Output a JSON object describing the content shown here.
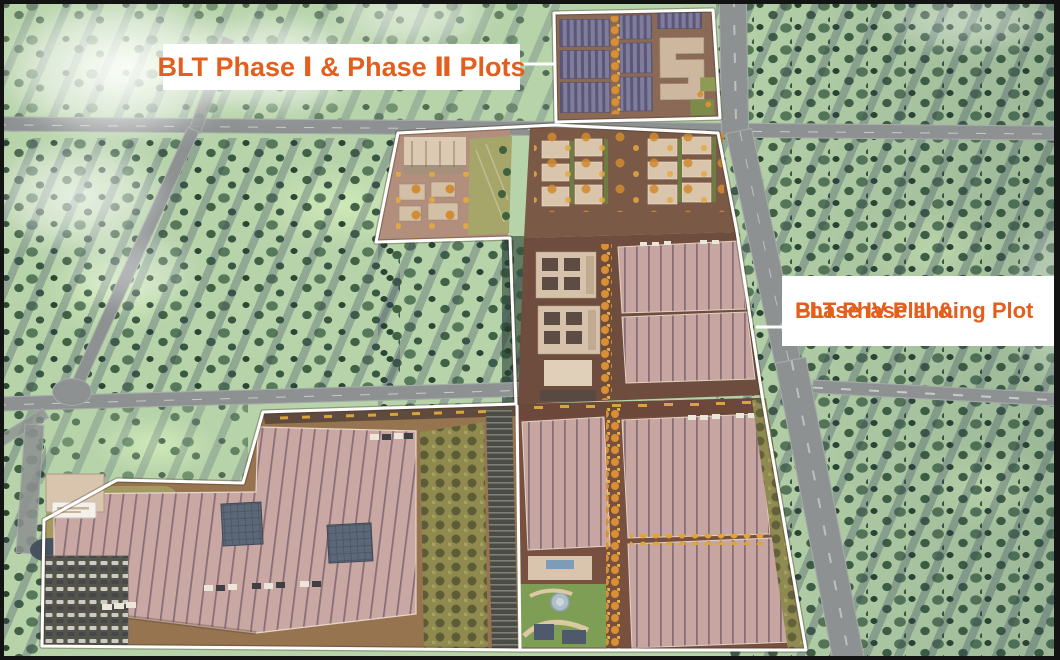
{
  "annotations": {
    "phase_1_2": {
      "label": "BLT Phase Ⅰ & Phase Ⅱ Plots"
    },
    "phase_3_4": {
      "label_line1": "BLT Phase III &",
      "label_line2": "Phase IV Planning Plot"
    }
  },
  "colors": {
    "annotation_text": "#e45f1d",
    "annotation_bg": "#ffffff",
    "plot_outline": "#ffffff",
    "field_green": "#b7d3aa",
    "road_gray": "#8d9191",
    "ground_brown": "#7a5645",
    "roof_pink": "#c7a5a1",
    "roof_seam": "#8a6e77",
    "roof_purple": "#7d7a9c",
    "building_tan": "#d9c5ab",
    "autumn_orange": "#d98f33",
    "autumn_yellow": "#e0a43c",
    "olive_field": "#a6a66b",
    "garden_green": "#7f9e55",
    "solar_blue": "#5c6878",
    "tree_green": "#3a5c46",
    "tree_shadow": "#3f4e66",
    "cloud_white": "#ffffff"
  }
}
